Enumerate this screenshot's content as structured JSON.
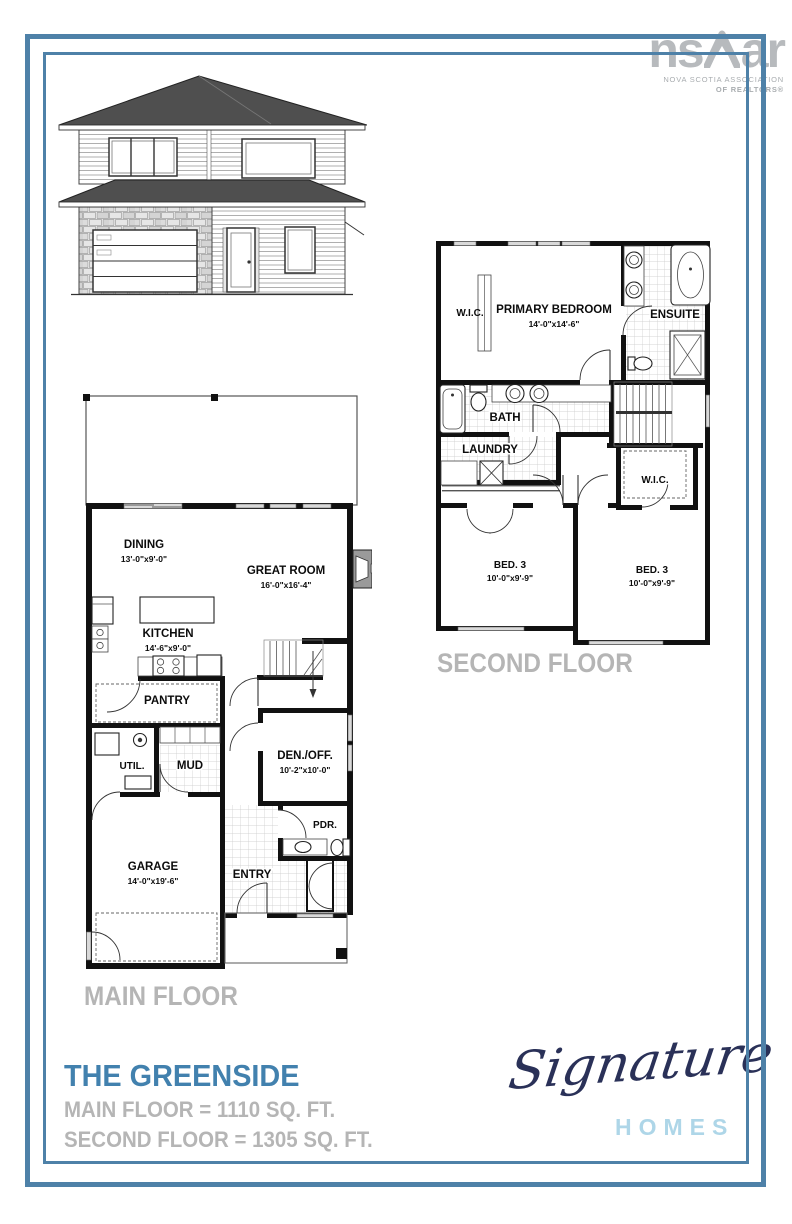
{
  "nsar_logo": {
    "wordmark_left": "ns",
    "wordmark_right": "ar",
    "caption_line1": "NOVA SCOTIA ASSOCIATION",
    "caption_line2": "OF REALTORS®"
  },
  "plan_labels": {
    "second_floor": "SECOND FLOOR",
    "main_floor": "MAIN FLOOR"
  },
  "second_floor": {
    "rooms": [
      {
        "name": "W.I.C.",
        "dims": ""
      },
      {
        "name": "PRIMARY BEDROOM",
        "dims": "14'-0\"x14'-6\""
      },
      {
        "name": "ENSUITE",
        "dims": ""
      },
      {
        "name": "BATH",
        "dims": ""
      },
      {
        "name": "LAUNDRY",
        "dims": ""
      },
      {
        "name": "W.I.C.",
        "dims": ""
      },
      {
        "name": "BED. 3",
        "dims": "10'-0\"x9'-9\""
      },
      {
        "name": "BED. 3",
        "dims": "10'-0\"x9'-9\""
      }
    ]
  },
  "main_floor": {
    "rooms": [
      {
        "name": "DINING",
        "dims": "13'-0\"x9'-0\""
      },
      {
        "name": "GREAT ROOM",
        "dims": "16'-0\"x16'-4\""
      },
      {
        "name": "KITCHEN",
        "dims": "14'-6\"x9'-0\""
      },
      {
        "name": "PANTRY",
        "dims": ""
      },
      {
        "name": "UTIL.",
        "dims": ""
      },
      {
        "name": "MUD",
        "dims": ""
      },
      {
        "name": "DEN./OFF.",
        "dims": "10'-2\"x10'-0\""
      },
      {
        "name": "PDR.",
        "dims": ""
      },
      {
        "name": "GARAGE",
        "dims": "14'-0\"x19'-6\""
      },
      {
        "name": "ENTRY",
        "dims": ""
      }
    ]
  },
  "title_block": {
    "plan_name": "THE GREENSIDE",
    "main_floor_area": "MAIN FLOOR = 1110 SQ. FT.",
    "second_floor_area": "SECOND FLOOR = 1305 SQ. FT."
  },
  "builder_logo": {
    "script": "Signature",
    "caps": "HOMES"
  },
  "colors": {
    "frame_blue": "#4e81a8",
    "title_blue": "#4281ae",
    "label_gray": "#b5b5b5",
    "logo_navy": "#2a3158",
    "logo_light_blue": "#aed6e8",
    "nsar_gray": "#b7babd"
  }
}
